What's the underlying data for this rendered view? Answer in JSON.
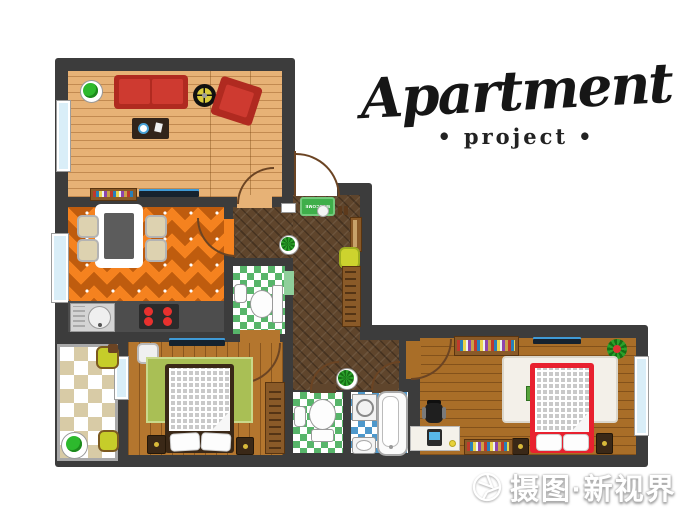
{
  "title": {
    "main": "Apartment",
    "subtitle": "project",
    "dot": "•"
  },
  "entrance": {
    "mat_text": "WELCOME"
  },
  "watermark": {
    "text": "摄图·新视界"
  },
  "palette": {
    "wall": "#3c3c3c",
    "living_wood": "#e7b276",
    "kitchen_orange": "#f5821f",
    "kitchen_diamond": "#bf5c0e",
    "corridor_parquet": "#5f452c",
    "wc_tile_green": "#57b56a",
    "bath_tile_blue": "#4e98cb",
    "balcony_tile_beige": "#d8cba6",
    "bedroom_wood": "#b4762e",
    "sofa_red": "#c0392b",
    "bed_red": "#e8212f",
    "rug_green": "#a9bf55",
    "rug_white": "#f3f0e9",
    "window_blue": "#d9eef8",
    "mat_green": "#3fae4a",
    "plant_green": "#2db92d"
  }
}
